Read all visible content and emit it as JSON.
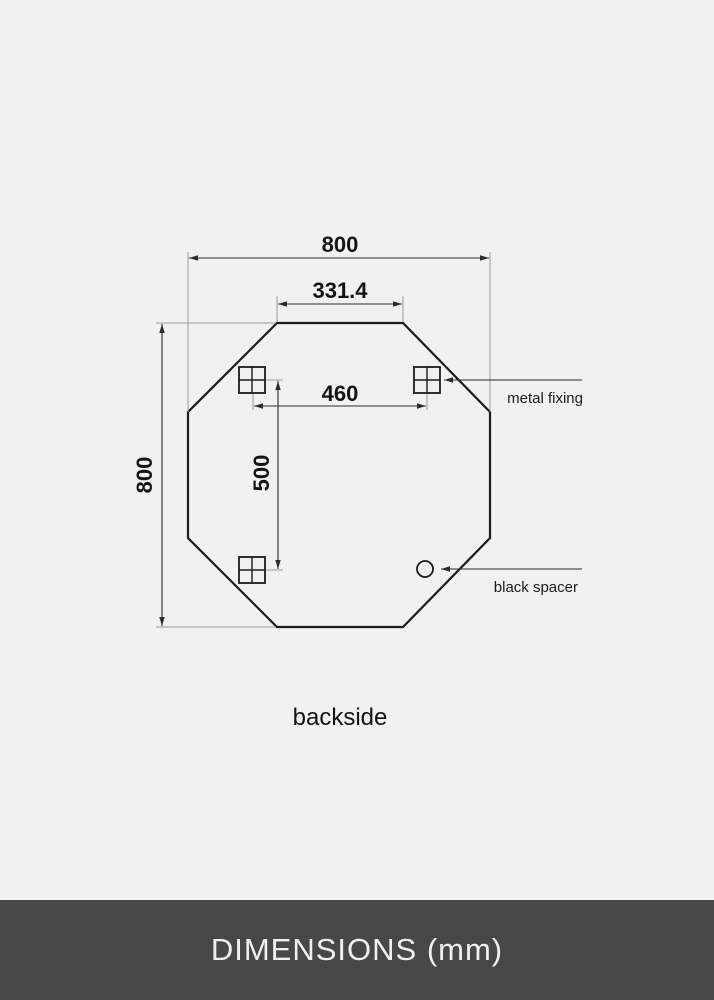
{
  "diagram": {
    "dimensions": {
      "width_total": "800",
      "top_edge": "331.4",
      "height_total": "800",
      "fixing_spacing_horizontal": "460",
      "fixing_spacing_vertical": "500"
    },
    "labels": {
      "metal_fixing": "metal fixing",
      "black_spacer": "black spacer",
      "view": "backside"
    },
    "shape": "octagon",
    "unit": "mm"
  },
  "footer": {
    "title": "DIMENSIONS (mm)"
  },
  "colors": {
    "background": "#f1f1f2",
    "line": "#1b1b1b",
    "dim_line": "#2b2b2b",
    "extension_line": "#9a9a9a",
    "footer_bg": "#484848",
    "footer_text": "#f0f0f0"
  }
}
